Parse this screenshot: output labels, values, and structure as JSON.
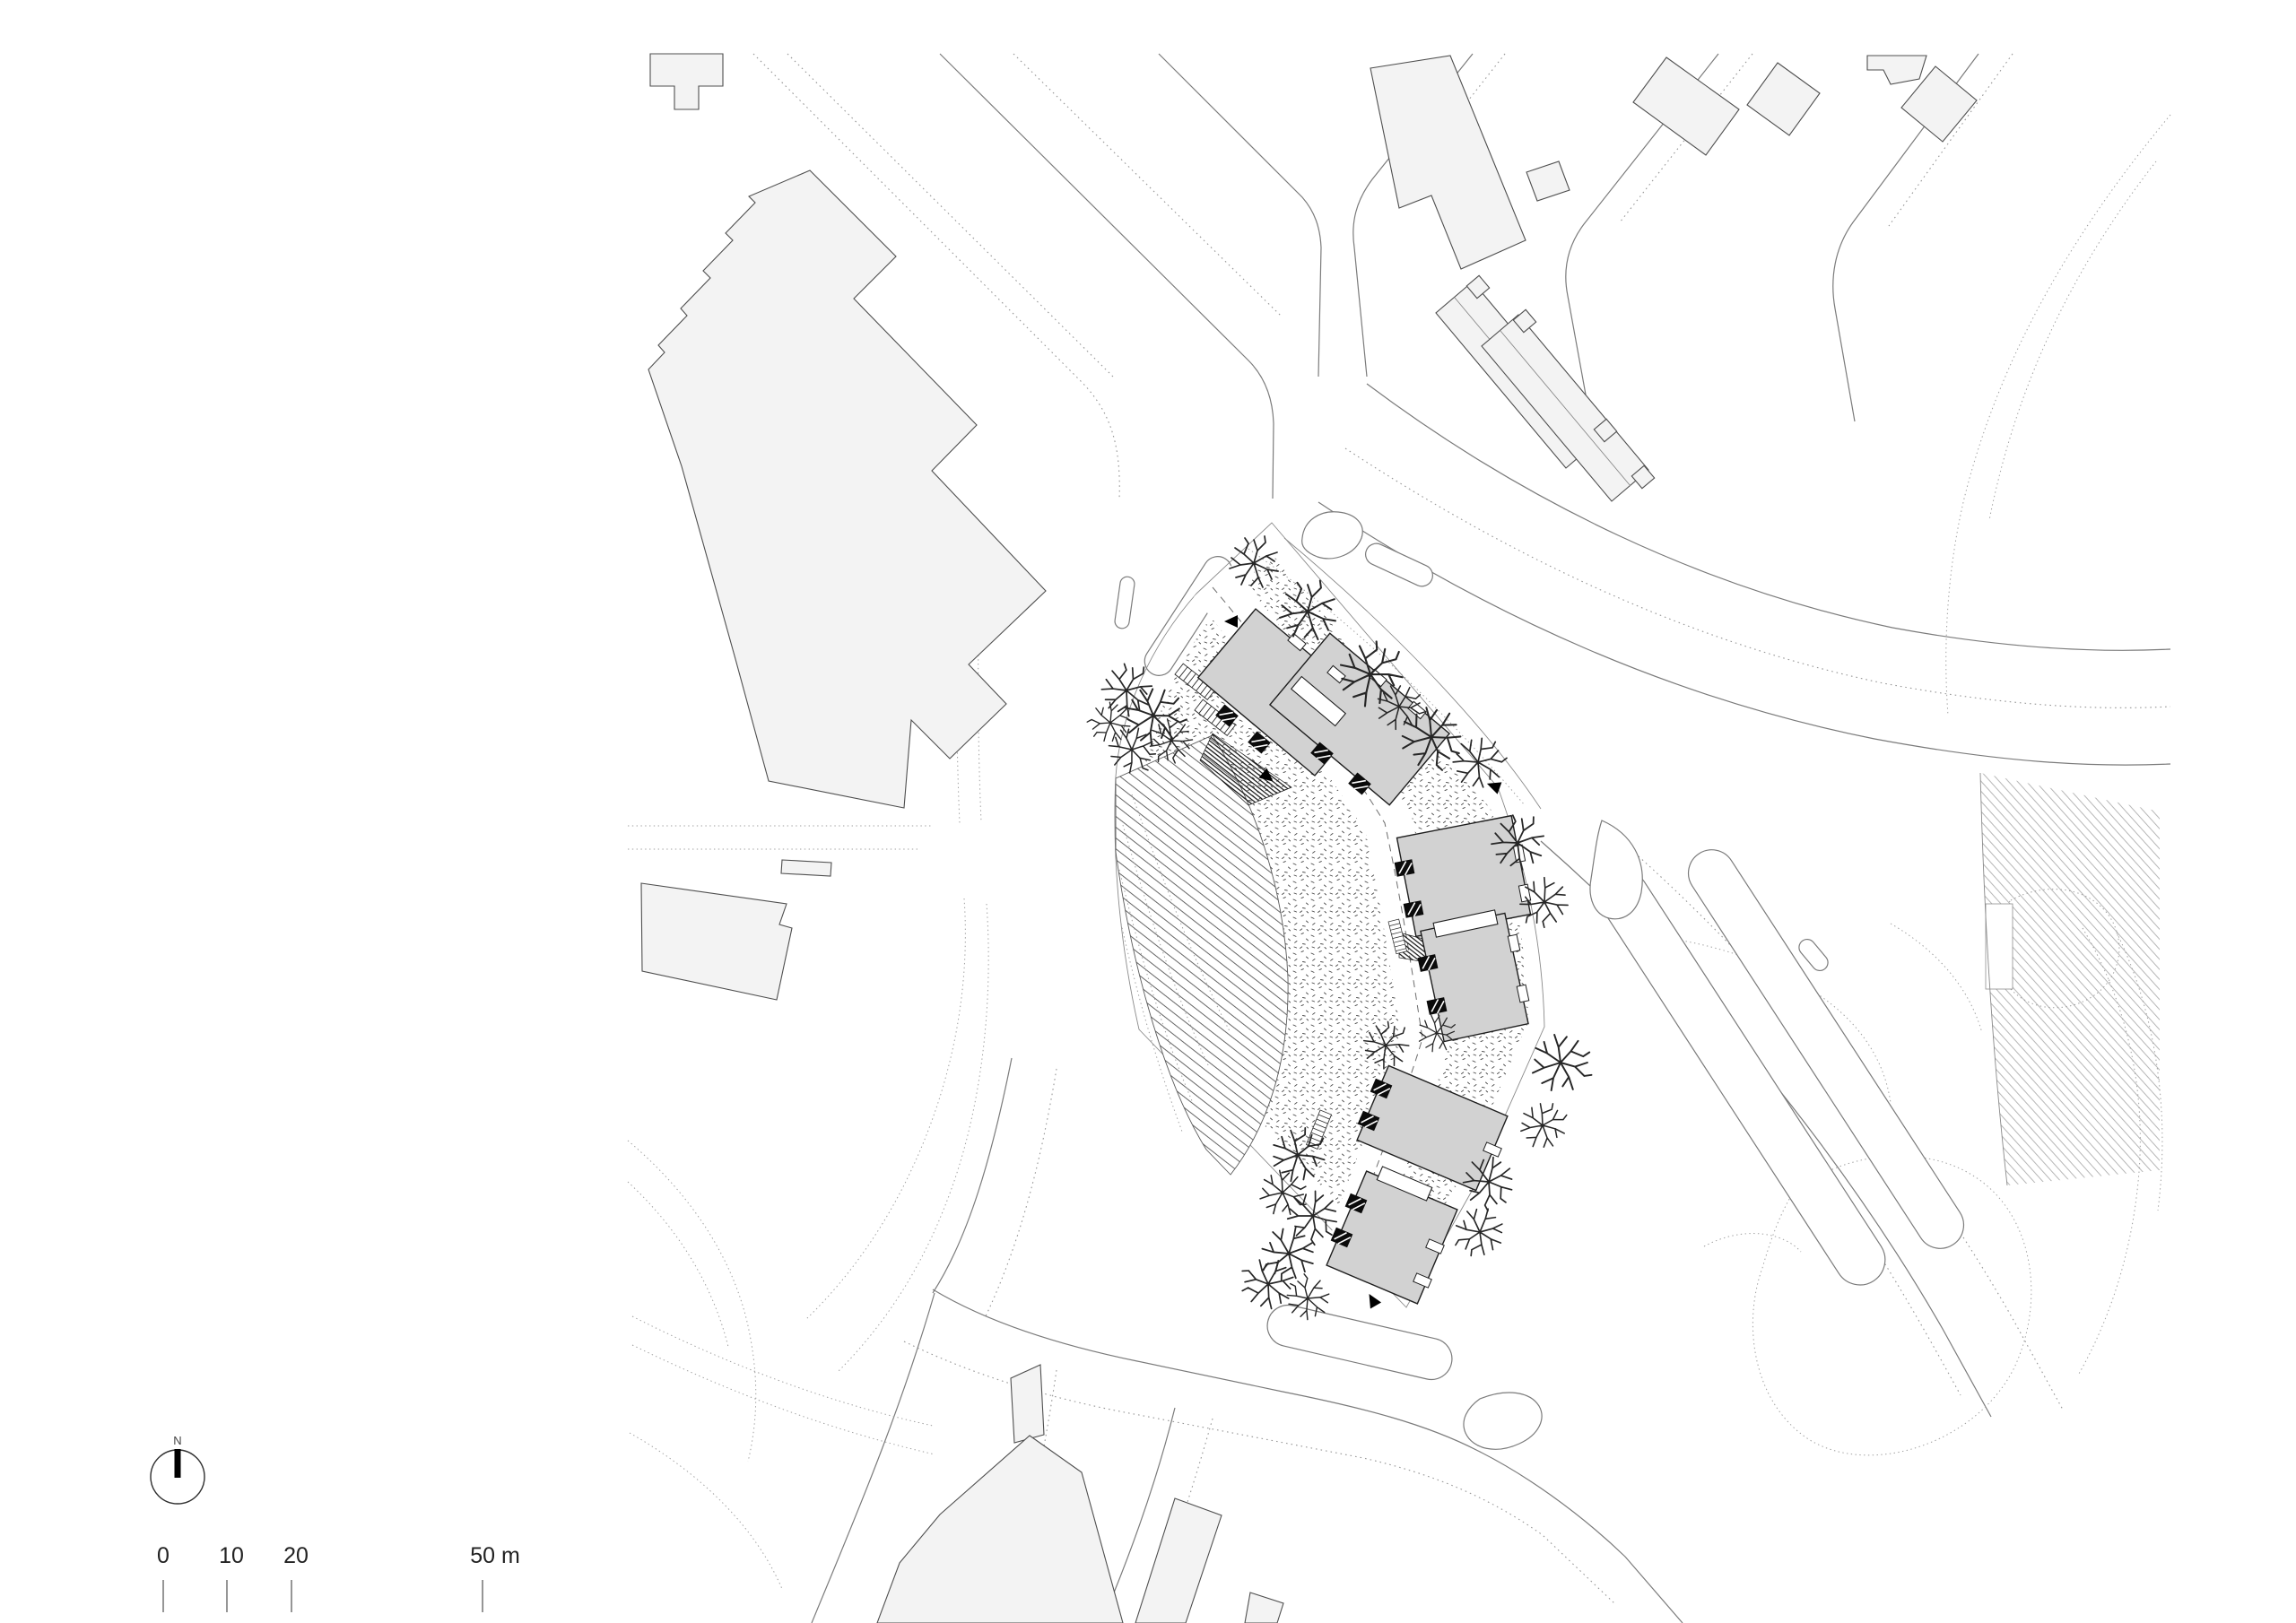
{
  "drawing": {
    "kind": "architectural site plan",
    "site_building_count": 6,
    "site_building_pairs": 3,
    "ground_textures": [
      "diagonal-hatch meadow",
      "stippled gravel"
    ],
    "features": [
      "street trees",
      "traffic islands",
      "entrance arrows",
      "context buildings",
      "terrain contour dots"
    ]
  },
  "compass": {
    "label": "N"
  },
  "scale_bar": {
    "unit": "m",
    "labels": [
      "0",
      "10",
      "20",
      "50 m"
    ],
    "tick_values_m": [
      0,
      10,
      20,
      50
    ]
  },
  "palette": {
    "background": "#ffffff",
    "context_building_fill": "#f3f3f3",
    "site_building_fill": "#d2d2d2",
    "linework": "#7b7b7b",
    "ink": "#1e1e1e"
  }
}
